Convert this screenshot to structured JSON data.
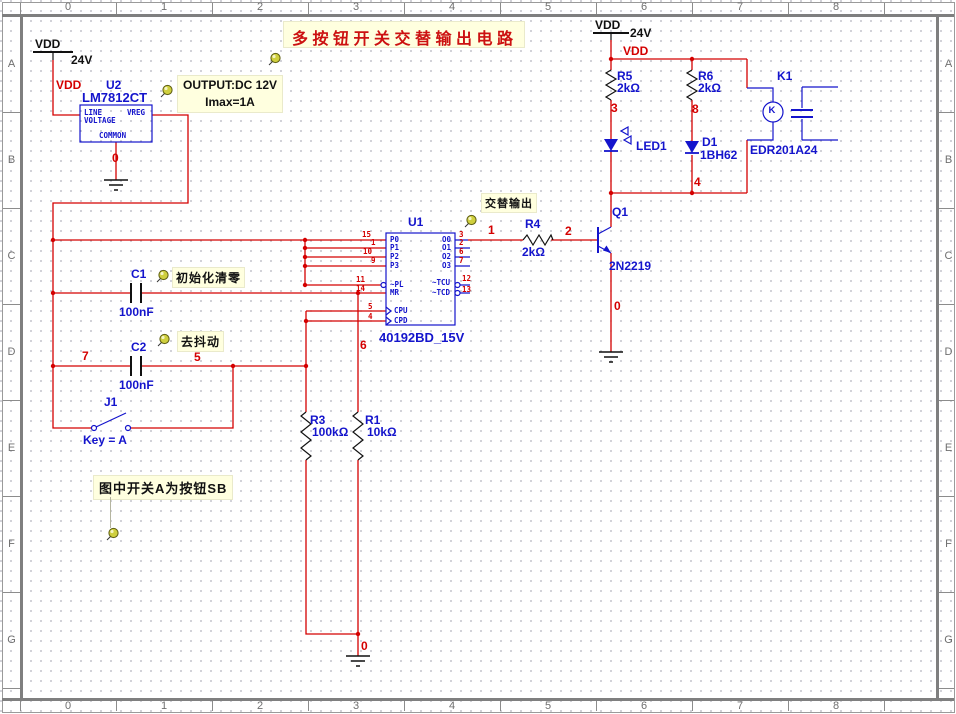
{
  "sheet": {
    "title": "多按钮开关交替输出电路",
    "columns": [
      "0",
      "1",
      "2",
      "3",
      "4",
      "5",
      "6",
      "7",
      "8"
    ],
    "rows": [
      "A",
      "B",
      "C",
      "D",
      "E",
      "F",
      "G"
    ]
  },
  "notes": {
    "output_line1": "OUTPUT:DC 12V",
    "output_line2": "Imax=1A",
    "alt_output": "交替输出",
    "init_clear": "初始化清零",
    "debounce": "去抖动",
    "switch_note": "图中开关A为按钮SB"
  },
  "power": {
    "vdd": "VDD",
    "v24": "24V"
  },
  "u2": {
    "ref": "U2",
    "part": "LM7812CT",
    "pin_line": "LINE",
    "pin_voltage": "VOLTAGE",
    "pin_vreg": "VREG",
    "pin_common": "COMMON"
  },
  "u1": {
    "ref": "U1",
    "part": "40192BD_15V",
    "left_pins": [
      {
        "name": "P0",
        "num": "15"
      },
      {
        "name": "P1",
        "num": "1"
      },
      {
        "name": "P2",
        "num": "10"
      },
      {
        "name": "P3",
        "num": "9"
      },
      {
        "name": "~PL",
        "num": "11"
      },
      {
        "name": "MR",
        "num": "14"
      },
      {
        "name": "CPU",
        "num": "5"
      },
      {
        "name": "CPD",
        "num": "4"
      }
    ],
    "right_pins": [
      {
        "name": "O0",
        "num": "3"
      },
      {
        "name": "O1",
        "num": "2"
      },
      {
        "name": "O2",
        "num": "6"
      },
      {
        "name": "O3",
        "num": "7"
      },
      {
        "name": "~TCU",
        "num": "12"
      },
      {
        "name": "~TCD",
        "num": "13"
      }
    ]
  },
  "parts": {
    "r1": {
      "ref": "R1",
      "value": "10kΩ"
    },
    "r3": {
      "ref": "R3",
      "value": "100kΩ"
    },
    "r4": {
      "ref": "R4",
      "value": "2kΩ"
    },
    "r5": {
      "ref": "R5",
      "value": "2kΩ"
    },
    "r6": {
      "ref": "R6",
      "value": "2kΩ"
    },
    "c1": {
      "ref": "C1",
      "value": "100nF"
    },
    "c2": {
      "ref": "C2",
      "value": "100nF"
    },
    "q1": {
      "ref": "Q1",
      "value": "2N2219"
    },
    "led1": {
      "ref": "LED1"
    },
    "d1": {
      "ref": "D1",
      "value": "1BH62"
    },
    "k1": {
      "ref": "K1",
      "value": "EDR201A24",
      "coil": "K"
    },
    "j1": {
      "ref": "J1",
      "value": "Key = A"
    }
  },
  "nets": {
    "n0": "0",
    "n1": "1",
    "n2": "2",
    "n3": "3",
    "n4": "4",
    "n5": "5",
    "n6": "6",
    "n7": "7",
    "n8": "8"
  },
  "colors": {
    "wire": "#d40000",
    "symbol": "#1414cc",
    "note_bg": "#ffffdf",
    "title": "#cc1111"
  }
}
